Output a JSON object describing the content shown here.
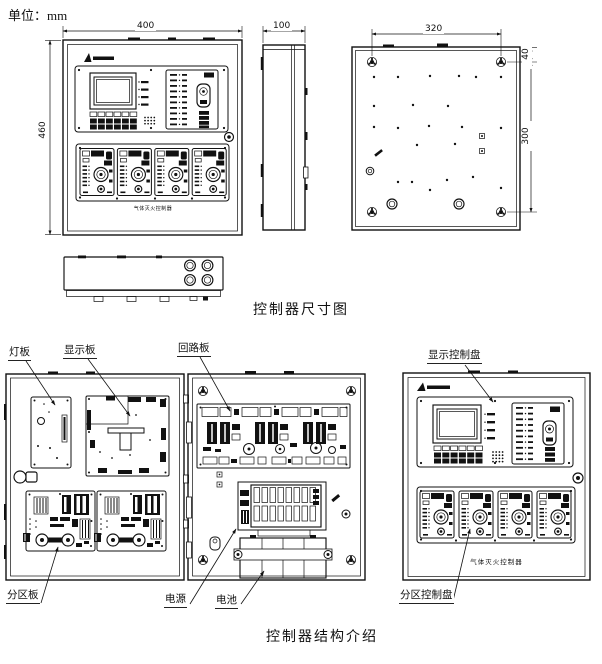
{
  "unit_label": "单位：mm",
  "captions": {
    "dimensions": "控制器尺寸图",
    "structure": "控制器结构介绍"
  },
  "dims": {
    "front_width": "400",
    "front_height": "460",
    "side_depth": "100",
    "back_hole_span": "320",
    "back_top_offset": "40",
    "back_hole_height": "300"
  },
  "part_labels": {
    "light_board": "灯板",
    "display_board": "显示板",
    "loop_board": "回路板",
    "zone_board": "分区板",
    "power_supply": "电源",
    "battery": "电池",
    "display_panel": "显示控制盘",
    "zone_panel": "分区控制盘"
  },
  "panel": {
    "product_name": "气体灭火控制器"
  },
  "colors": {
    "line": "#111111",
    "background": "#ffffff"
  }
}
